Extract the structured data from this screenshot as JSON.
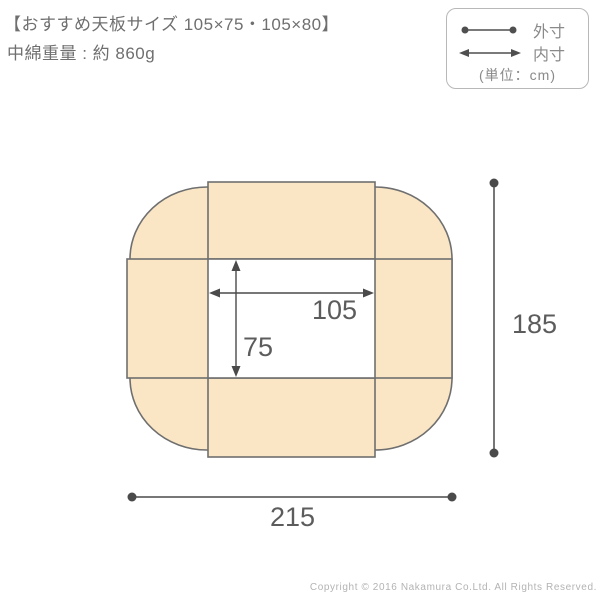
{
  "header": {
    "title": "【おすすめ天板サイズ 105×75・105×80】",
    "weight": "中綿重量 : 約 860g"
  },
  "legend": {
    "outer_label": "外寸",
    "inner_label": "内寸",
    "unit_label": "(単位：cm)"
  },
  "dimensions": {
    "inner_width": "105",
    "inner_height": "75",
    "outer_width": "215",
    "outer_height": "185"
  },
  "footer": {
    "copyright": "Copyright © 2016 Nakamura Co.Ltd. All Rights Reserved."
  },
  "colors": {
    "futon_fill": "#fae6c5",
    "outline_stroke": "#6f6f6f",
    "dimension_line": "#4a4a4a",
    "number_text": "#5c5c5c",
    "header_text": "#6f6f6f",
    "legend_text": "#8a8a8a",
    "legend_border": "#b8b8b8",
    "copyright_text": "#b3b3b3"
  }
}
